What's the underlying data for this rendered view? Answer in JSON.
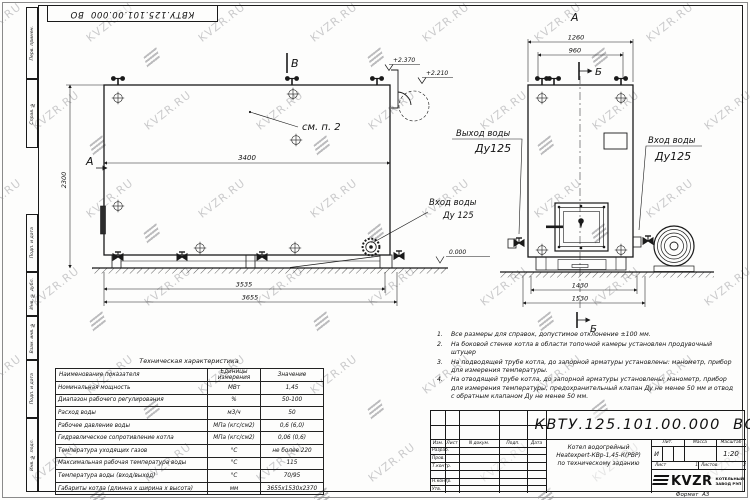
{
  "watermark": {
    "text": "KVZR.RU"
  },
  "stamp": {
    "doc_number": "КВТУ.125.101.00.000  ВО"
  },
  "margin_labels": [
    "Перв. примен.",
    "Справ. №",
    "Подп. и дата",
    "Инв. № дубл.",
    "Взам. инв. №",
    "Подп. и дата",
    "Инв. № подл."
  ],
  "side_view": {
    "view_label_a": "А",
    "view_label_v": "В",
    "callout": "см. п. 2",
    "dim_height": "2300",
    "dim_length": "3400",
    "dim_base": "3535",
    "dim_overall": "3655",
    "elev_top": "+2.370",
    "elev_collar": "+2.210",
    "elev_zero": "0.000",
    "inlet_line1": "Вход воды",
    "inlet_line2": "Ду 125"
  },
  "front_view": {
    "view_label_a": "А",
    "section_label_top": "Б",
    "section_label_bottom": "Б",
    "dim_width": "1260",
    "dim_valves": "960",
    "dim_base": "1430",
    "dim_overall": "1530",
    "outlet_line1": "Выход воды",
    "outlet_line2": "Ду125",
    "inlet_line1": "Вход воды",
    "inlet_line2": "Ду125"
  },
  "tech_table": {
    "title": "Техническая характеристика",
    "col_name": "Наименование показателя",
    "col_units_1": "Единицы",
    "col_units_2": "измерения",
    "col_value": "Значение",
    "rows": [
      {
        "name": "Номинальная мощность",
        "units": "МВт",
        "value": "1,45"
      },
      {
        "name": "Диапазон рабочего регулирования",
        "units": "%",
        "value": "50-100"
      },
      {
        "name": "Расход воды",
        "units": "м3/ч",
        "value": "50"
      },
      {
        "name": "Рабочее давление воды",
        "units": "МПа (кгс/см2)",
        "value": "0,6 (6,0)"
      },
      {
        "name": "Гидравлическое сопротивление котла",
        "units": "МПа (кгс/см2)",
        "value": "0,06 (0,6)"
      },
      {
        "name": "Температура уходящих газов",
        "units": "°С",
        "value": "не более 220"
      },
      {
        "name": "Максимальная рабочая температура воды",
        "units": "°С",
        "value": "115"
      },
      {
        "name": "Температура воды (вход/выход)",
        "units": "°С",
        "value": "70/95"
      },
      {
        "name": "Габариты котла (длинна х ширина х высота)",
        "units": "мм",
        "value": "3655х1530х2370"
      }
    ]
  },
  "notes": [
    {
      "num": "1.",
      "text": "Все размеры для справок, допустимое отклонение  ±100 мм."
    },
    {
      "num": "2.",
      "text": "На боковой стенке котла в области топочной камеры установлен продувочный штуцер"
    },
    {
      "num": "3.",
      "text": "На  подводящей трубе котла, до запорной арматуры установлены:  манометр, прибор для измерения температуры."
    },
    {
      "num": "4.",
      "text": "На отводящей трубе котла, до запорной арматуры установлены:  манометр, прибор для измерения температуры, предохранительный клапан  Ду не менее  50 мм и отвод с обратным клапаном  Ду не менее  50 мм."
    }
  ],
  "title_block": {
    "doc_number": "КВТУ.125.101.00.000  ВО",
    "header_cols": [
      "Изм.",
      "Лист",
      "N докум.",
      "Подп.",
      "Дата"
    ],
    "roles": [
      "Разраб.",
      "Пров.",
      "Т.контр.",
      "Н.контр.",
      "Утв."
    ],
    "description_line1": "Котел водогрейный",
    "description_line2": "Heatexpert-КВр-1,45-К(РВР)",
    "description_line3": "по техническому заданию",
    "lit_header": "Лит.",
    "mass_header": "Масса",
    "scale_header": "Масштаб",
    "lit_value": "И",
    "scale_value": "1:20",
    "sheet_label": "Лист",
    "sheet_value": "1",
    "sheets_label": "Листов",
    "sheets_value": "2",
    "company_logo_text": "KVZR",
    "company_line1": "КОТЕЛЬНЫЙ",
    "company_line2": "ЗАВОД РЭП",
    "format_label": "Формат",
    "format_value": "А3"
  }
}
